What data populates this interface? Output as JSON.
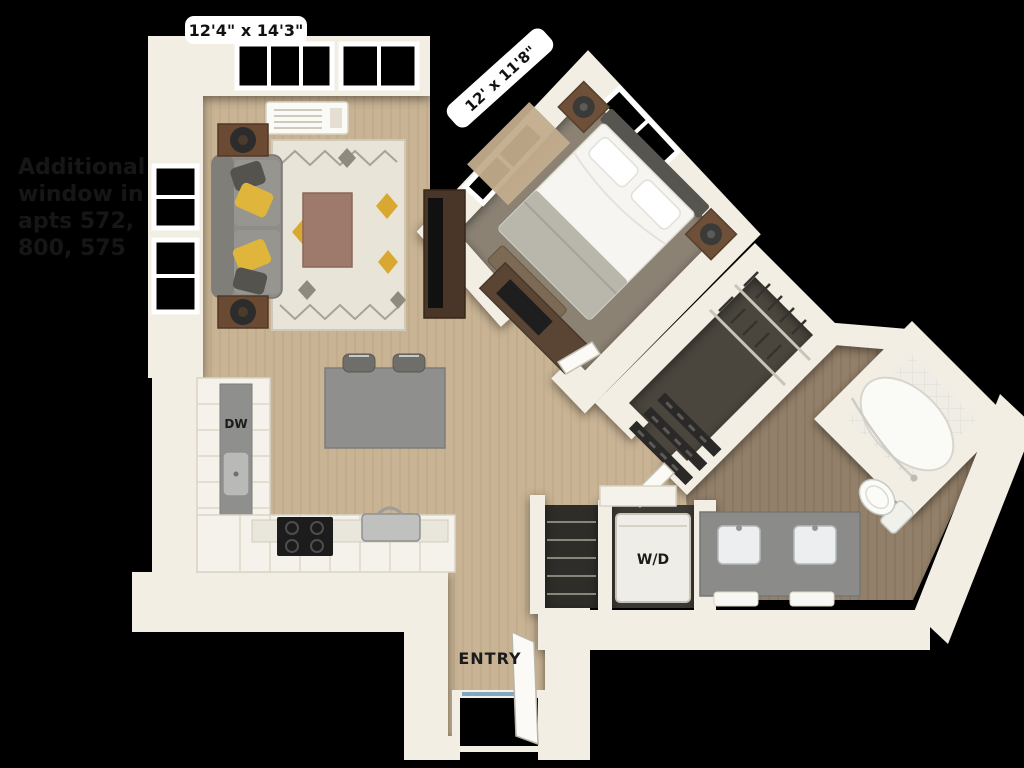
{
  "scene": {
    "type": "3d-floor-plan-render",
    "background": "#000000"
  },
  "note": {
    "lines": [
      "Additional",
      "window in",
      "apts 572,",
      "800, 575"
    ],
    "color": "#161616"
  },
  "labels": {
    "living_dimensions": "12'4\" x 14'3\"",
    "bedroom_dimensions": "12' x 11'8\"",
    "dishwasher": "DW",
    "washer_dryer": "W/D",
    "entry": "ENTRY"
  },
  "colors": {
    "wall": "#f2eee3",
    "wall_edge": "#d8d1bf",
    "wood_floor": "#c8b394",
    "bath_floor": "#93806a",
    "bedroom_carpet": "#8b8274",
    "closet_carpet": "#4a463e",
    "counter_gray": "#8f8f8d",
    "sofa_gray": "#8e8d88",
    "accent_pillow_yellow": "#e0b53c",
    "furniture_brown": "#6a4a33"
  }
}
